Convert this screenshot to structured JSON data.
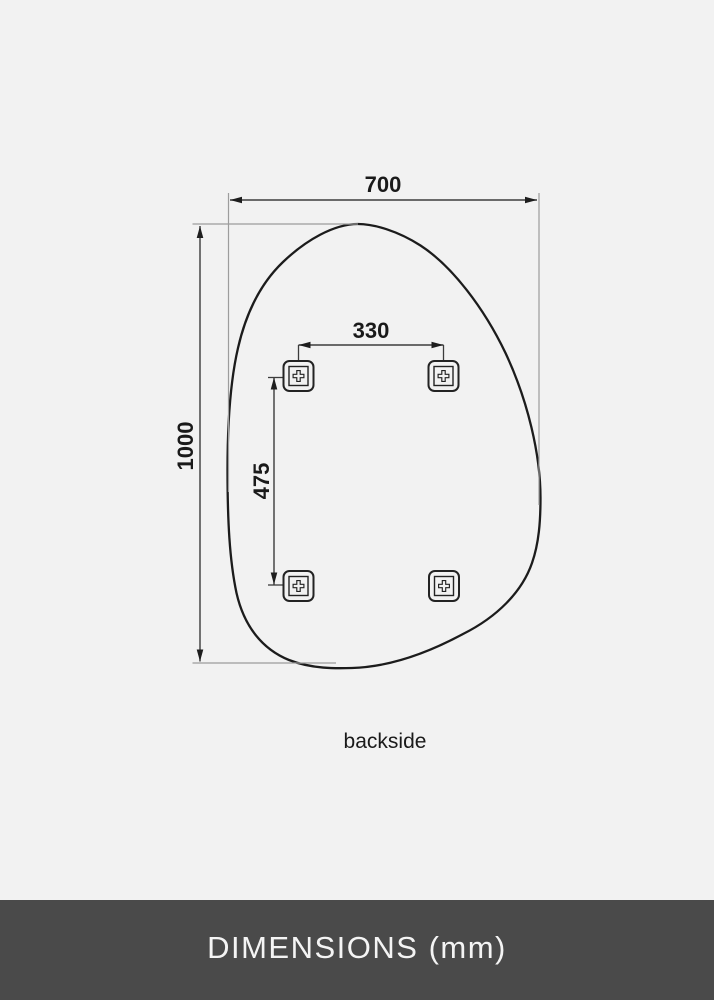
{
  "theme": {
    "page-bg": "#f2f2f2",
    "outline-color": "#1c1c1c",
    "dim-line-color": "#3c3c3c",
    "ext-line-color": "#9d9d9d",
    "label-color": "#1a1a1a",
    "footer-bg": "#4a4a4a",
    "footer-text": "#f4f4f4"
  },
  "diagram": {
    "kind": "technical-dimension-drawing",
    "subject": "organic pebble-shaped mirror seen from the back with four mounting brackets",
    "unit": "mm",
    "view_caption": "backside",
    "measurements": {
      "overall_width": {
        "value": 700,
        "label": "700"
      },
      "overall_height": {
        "value": 1000,
        "label": "1000"
      },
      "bracket_spacing_horizontal": {
        "value": 330,
        "label": "330"
      },
      "bracket_spacing_vertical": {
        "value": 475,
        "label": "475"
      }
    },
    "brackets": [
      {
        "position": "top-left",
        "icon": "screw-cross-icon"
      },
      {
        "position": "top-right",
        "icon": "screw-cross-icon"
      },
      {
        "position": "bottom-left",
        "icon": "screw-cross-icon"
      },
      {
        "position": "bottom-right",
        "icon": "screw-cross-icon"
      }
    ]
  },
  "footer": {
    "label": "DIMENSIONS (mm)"
  }
}
